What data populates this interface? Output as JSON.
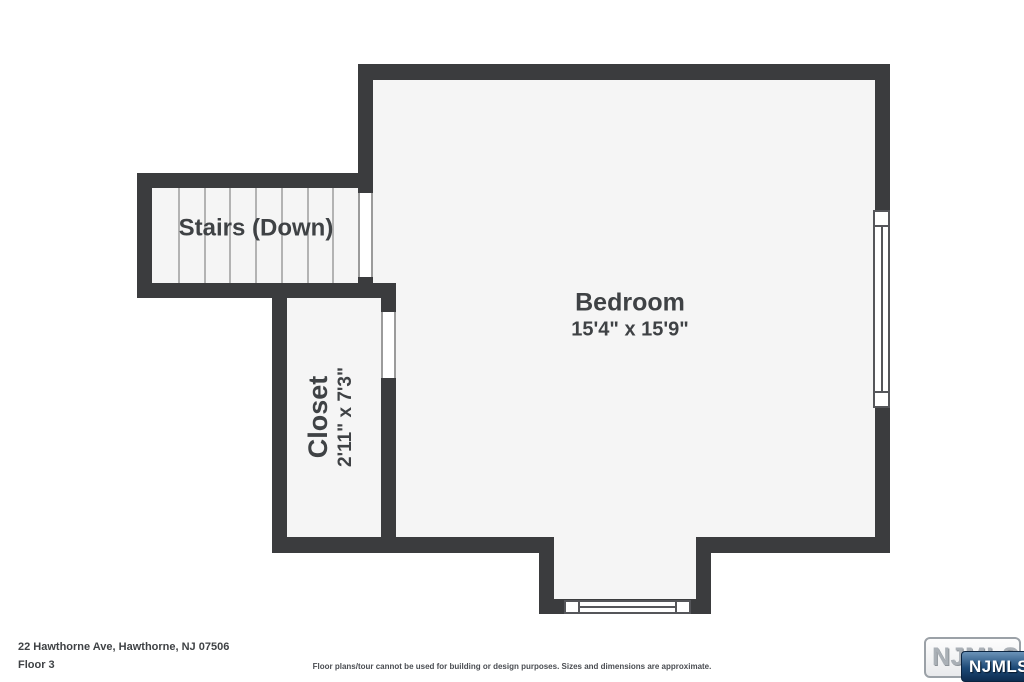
{
  "plan": {
    "rooms": {
      "stairs": {
        "name": "Stairs (Down)"
      },
      "bedroom": {
        "name": "Bedroom",
        "dims": "15'4\" x 15'9\""
      },
      "closet": {
        "name": "Closet",
        "dims": "2'11\" x 7'3\""
      }
    },
    "colors": {
      "wall": "#3b3c3e",
      "floor": "#f5f5f5",
      "label": "#3f4245"
    }
  },
  "footer": {
    "address": "22 Hawthorne Ave, Hawthorne, NJ 07506",
    "floor": "Floor 3",
    "disclaimer": "Floor plans/tour cannot be used for building or design purposes. Sizes and dimensions are approximate."
  },
  "logo": {
    "watermark": "NJMLS",
    "badge": "NJMLS"
  }
}
